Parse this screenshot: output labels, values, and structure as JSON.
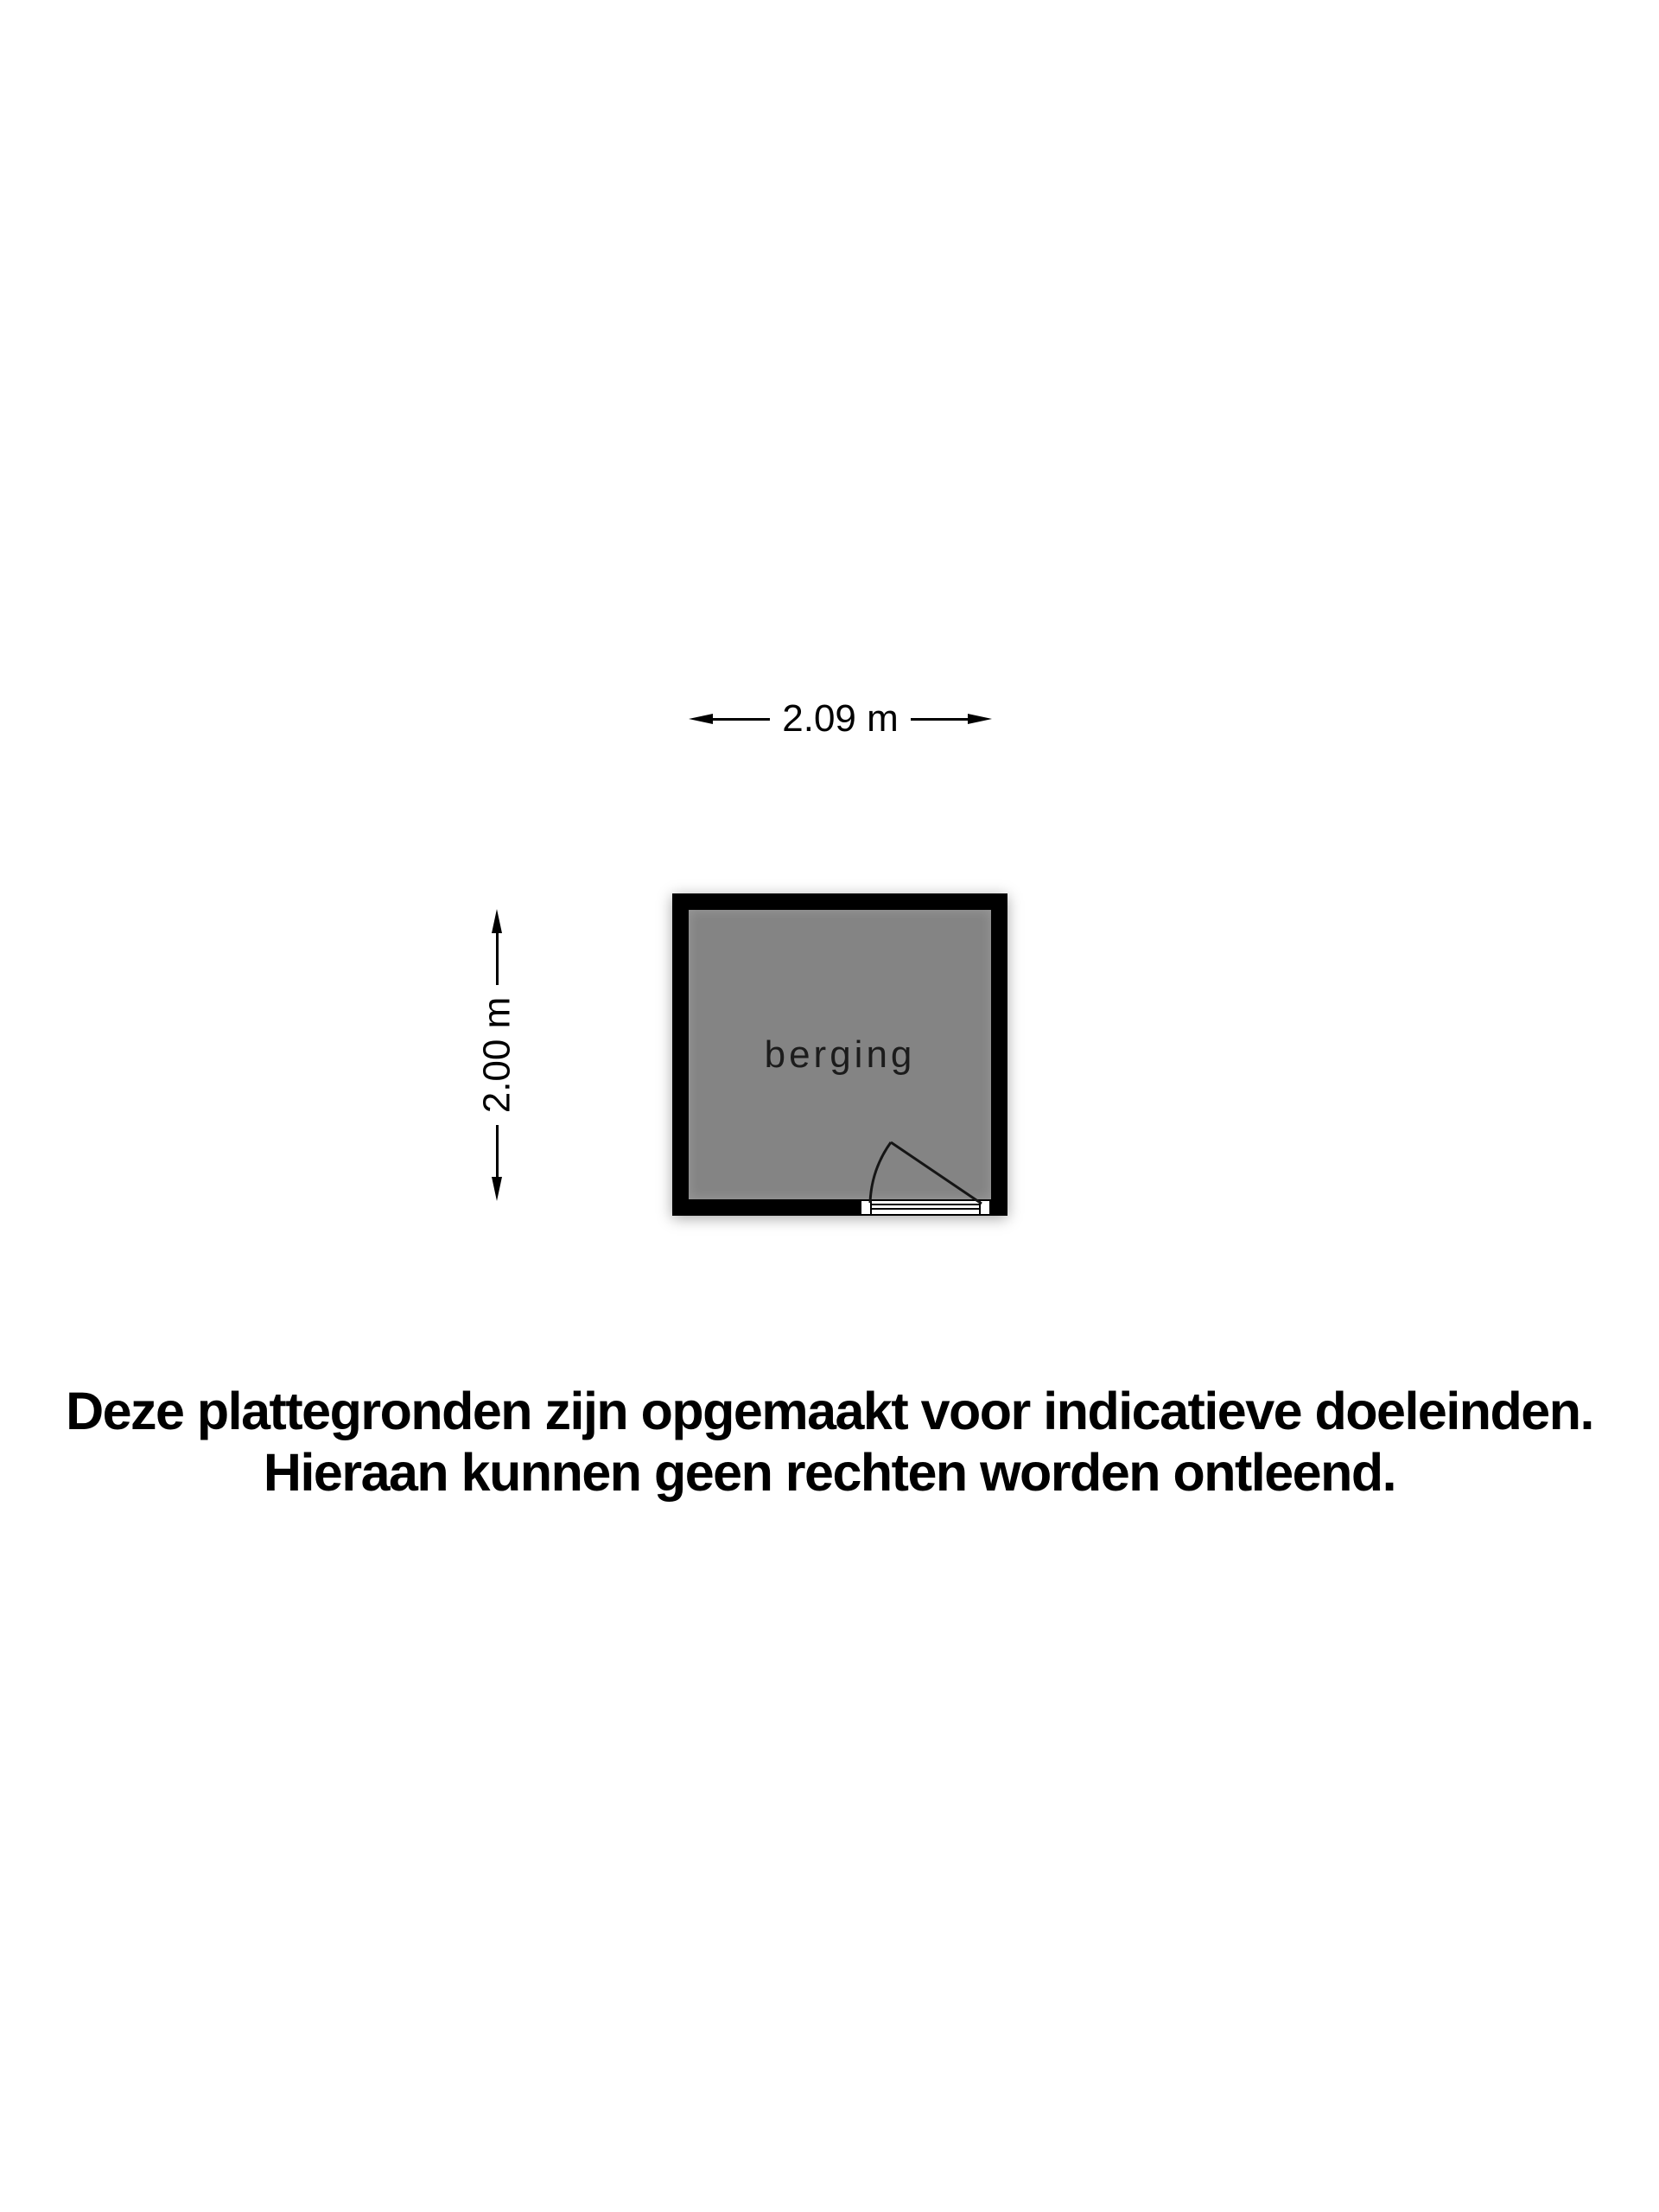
{
  "floor_plan": {
    "room": {
      "label": "berging",
      "floor_color": "#848484",
      "wall_color": "#000000"
    },
    "dimensions": {
      "width_label": "2.09 m",
      "height_label": "2.00 m"
    },
    "door": {
      "position": "bottom-right",
      "swing": "inward-left"
    }
  },
  "disclaimer": {
    "lines": [
      "Deze plattegronden zijn opgemaakt voor indicatieve doeleinden.",
      "Hieraan kunnen geen rechten worden ontleend."
    ]
  },
  "colors": {
    "background": "#ffffff",
    "text": "#000000",
    "room_label_text": "#1c1c1c"
  }
}
